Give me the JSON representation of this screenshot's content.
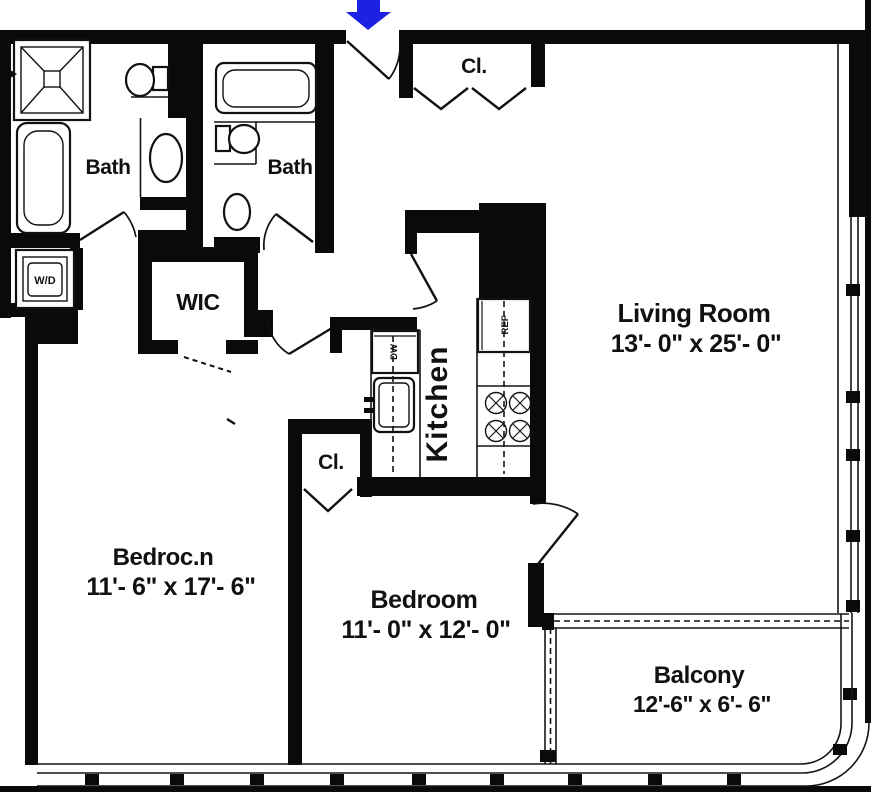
{
  "plan": {
    "type": "apartment-floor-plan",
    "colors": {
      "wall": "#0a0a0a",
      "entry_arrow": "#1c22e3",
      "background": "#ffffff"
    },
    "labels": {
      "bath1": "Bath",
      "bath2": "Bath",
      "wic": "WIC",
      "washer_dryer": "W/D",
      "closet_entry": "Cl.",
      "closet_bedroom": "Cl.",
      "kitchen": "Kitchen",
      "dishwasher": "DW",
      "refrigerator": "REF"
    },
    "rooms": {
      "living_room": {
        "name": "Living Room",
        "dimensions": "13'- 0\" x 25'- 0\""
      },
      "bedroom_1": {
        "name": "Bedroc.n",
        "dimensions": "11'- 6\" x 17'- 6\""
      },
      "bedroom_2": {
        "name": "Bedroom",
        "dimensions": "11'- 0\" x 12'- 0\""
      },
      "balcony": {
        "name": "Balcony",
        "dimensions": "12'-6\" x 6'- 6\""
      }
    }
  }
}
